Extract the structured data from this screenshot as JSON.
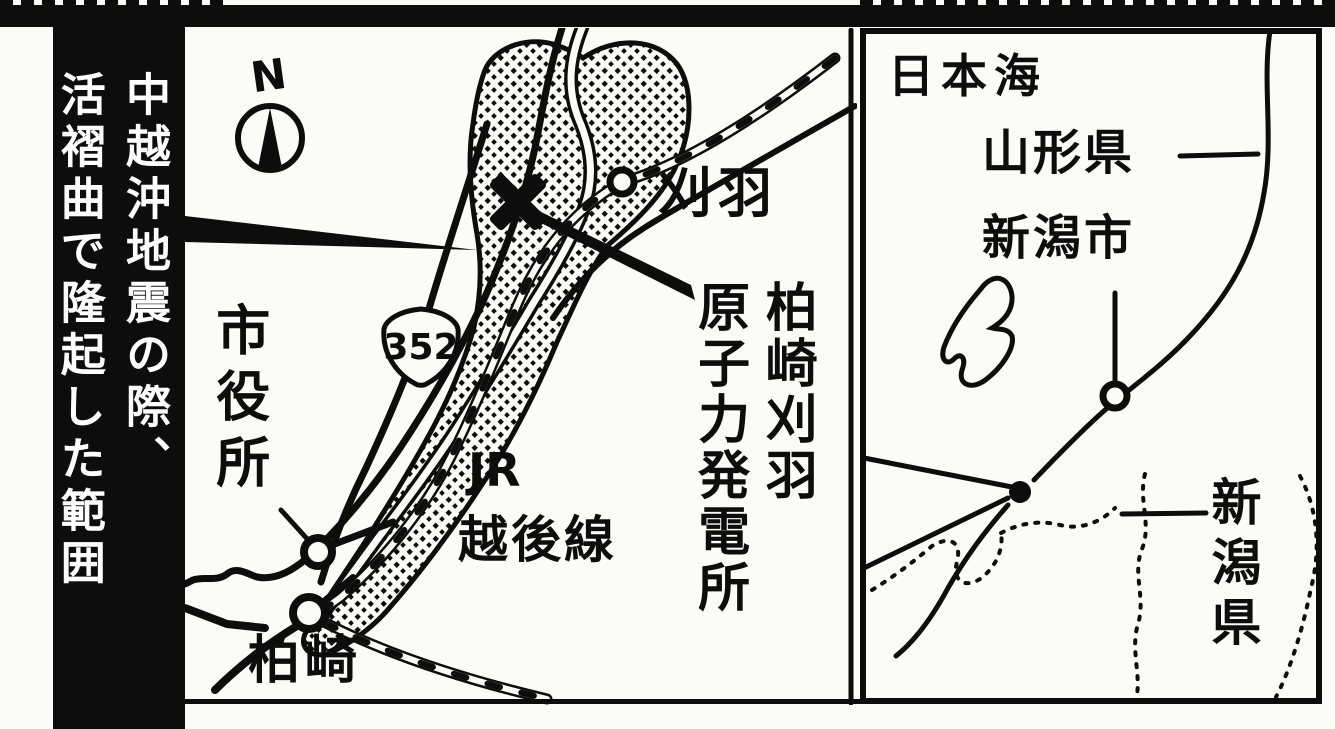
{
  "figure": {
    "type": "newspaper-map",
    "subject": "Kashiwazaki-Kariwa nuclear power plant uplift zone map"
  },
  "banner": {
    "line1": "中越沖地震の際、",
    "line2": "活褶曲で隆起した範囲"
  },
  "compass": {
    "north_label": "N"
  },
  "map": {
    "route_badge": "352",
    "labels": {
      "kariwa_town": "刈羽",
      "plant_line1": "柏崎刈羽",
      "plant_line2": "原子力発電所",
      "jr": "JR",
      "echigo_line": "越後線",
      "city_hall": "市役所",
      "kashiwazaki": "柏崎"
    }
  },
  "inset": {
    "labels": {
      "sea_of_japan": "日本海",
      "yamagata_pref": "山形県",
      "niigata_city": "新潟市",
      "niigata_pref": "新潟県"
    }
  },
  "colors": {
    "ink": "#0d0d0d",
    "paper": "#fbfbf8"
  }
}
